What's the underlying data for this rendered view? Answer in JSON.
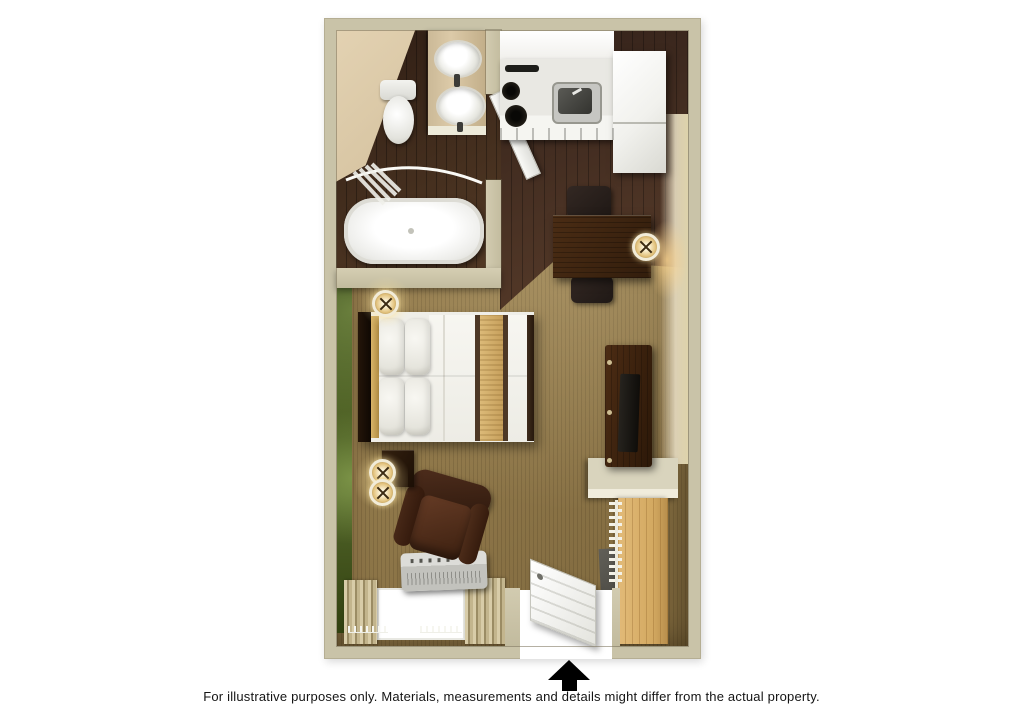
{
  "image_type": "3d-floorplan-rendering",
  "caption": "For illustrative purposes only.  Materials, measurements and details might differ from the actual property.",
  "entrance_marker": {
    "shape": "arrow-up",
    "color": "#000000"
  },
  "palette": {
    "background": "#ffffff",
    "wall": "#c9c3a8",
    "interior_wall_face": "#d9c6a5",
    "hardwood_floor": "#46301f",
    "carpet": "#8d7649",
    "accent_wall_green": "#46581f",
    "bed_runner_gold": "#d6b475",
    "closet_wood": "#d9b271",
    "fixtures_white": "#f3f3f0",
    "furniture_dark_wood": "#34200f",
    "arrow": "#000000"
  },
  "rooms": {
    "bathroom": {
      "fixtures": [
        "toilet",
        "vanity-sink",
        "mirrored-sink",
        "bathtub",
        "shower-curtain-rod",
        "door"
      ]
    },
    "kitchen": {
      "fixtures": [
        "upper-cabinets",
        "counter",
        "stove-burners",
        "sink",
        "refrigerator"
      ]
    },
    "studio_room": {
      "furnishings": [
        "queen-bed",
        "pillows",
        "headboard",
        "nightstand",
        "wall-sconces",
        "desk",
        "desk-chairs",
        "desk-lamp",
        "tv-console",
        "tv",
        "armchair",
        "ptac-ac-unit",
        "window",
        "curtains",
        "closet-shelf",
        "closet-rod-hangers",
        "closet",
        "entry-door",
        "floor-mat"
      ]
    }
  }
}
